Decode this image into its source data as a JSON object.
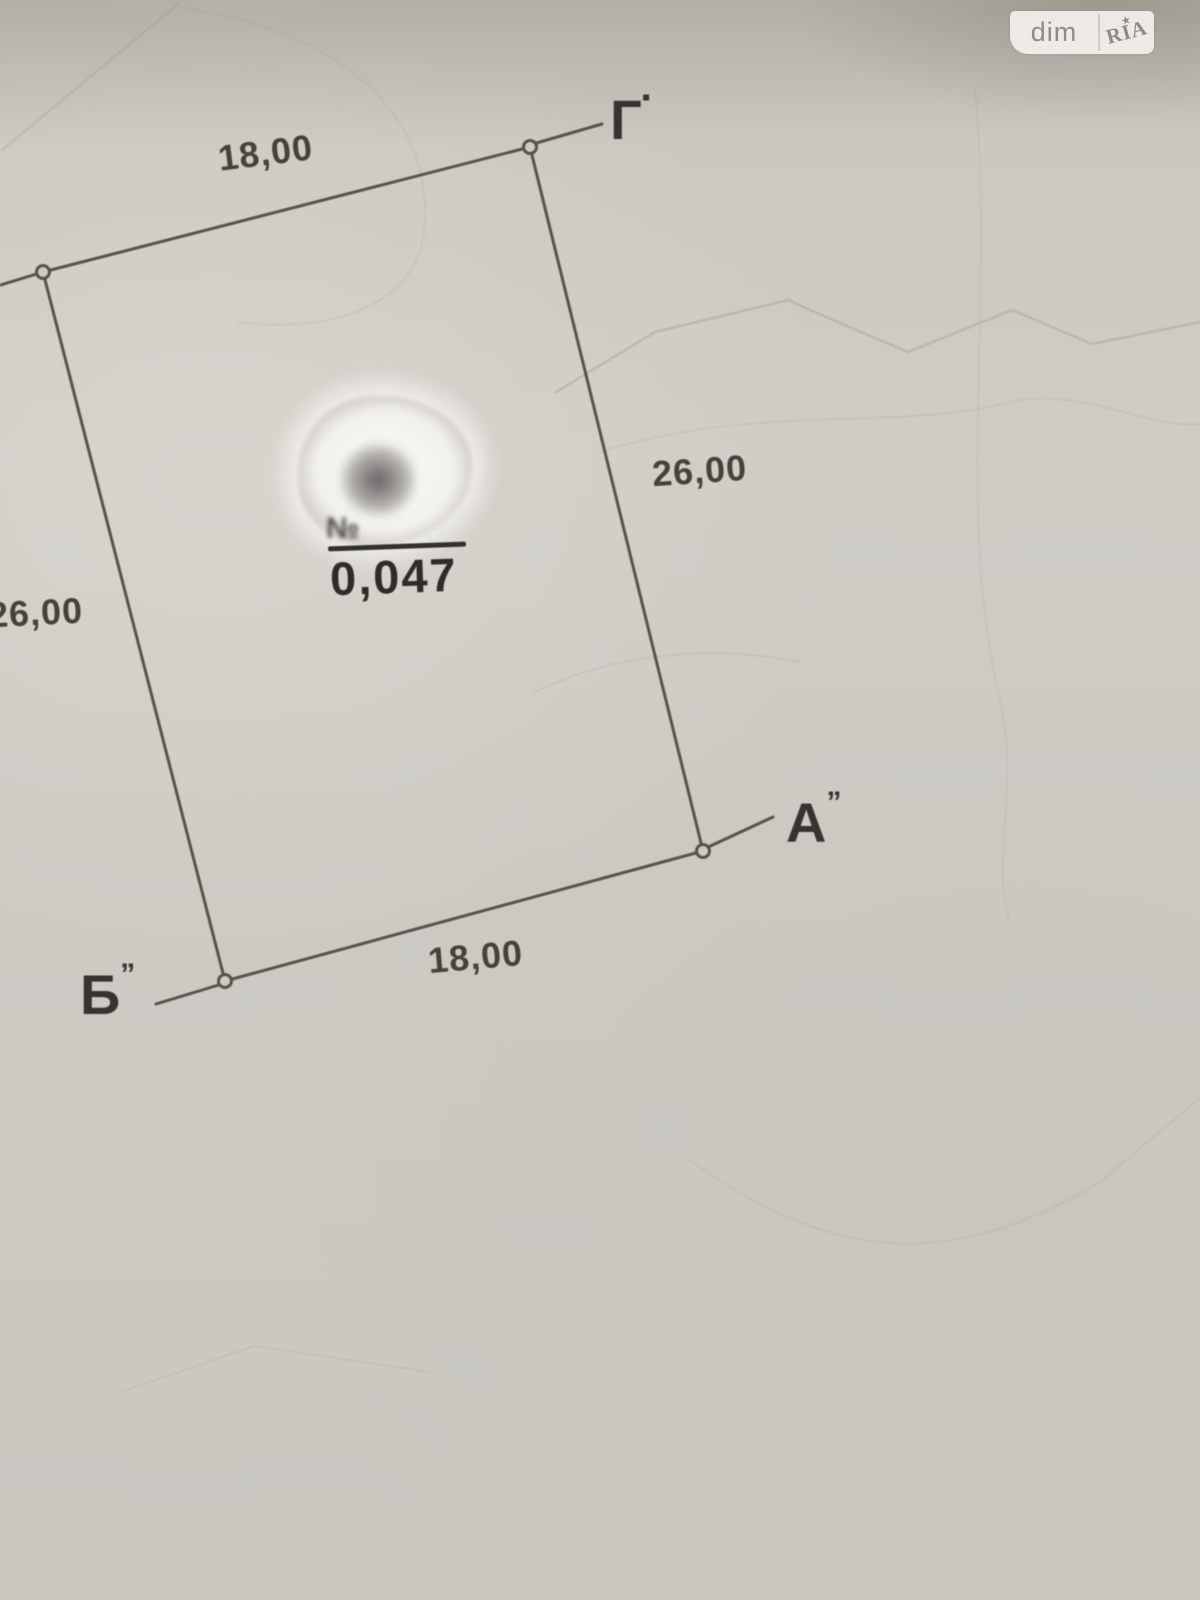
{
  "watermark": {
    "left_text": "dim",
    "right_text": "RIA",
    "star": "★"
  },
  "plot_plan": {
    "corners": {
      "top_right": {
        "label": "Г",
        "mark": "▪"
      },
      "right": {
        "label": "А",
        "mark": "”"
      },
      "bottom_left": {
        "label": "Б",
        "mark": "”"
      }
    },
    "dimensions": {
      "top": "18,00",
      "right": "26,00",
      "left": "26,00",
      "bottom": "18,00"
    },
    "area": {
      "value": "0,047",
      "obscured_prefix": "№"
    }
  },
  "colors": {
    "paper": "#cdcac4",
    "boundary_line": "#57534c",
    "label_text": "#3a3834",
    "whiteout": "#f3f2ef",
    "watermark_bg": "#f0eeea",
    "watermark_text": "#8f8b84"
  }
}
